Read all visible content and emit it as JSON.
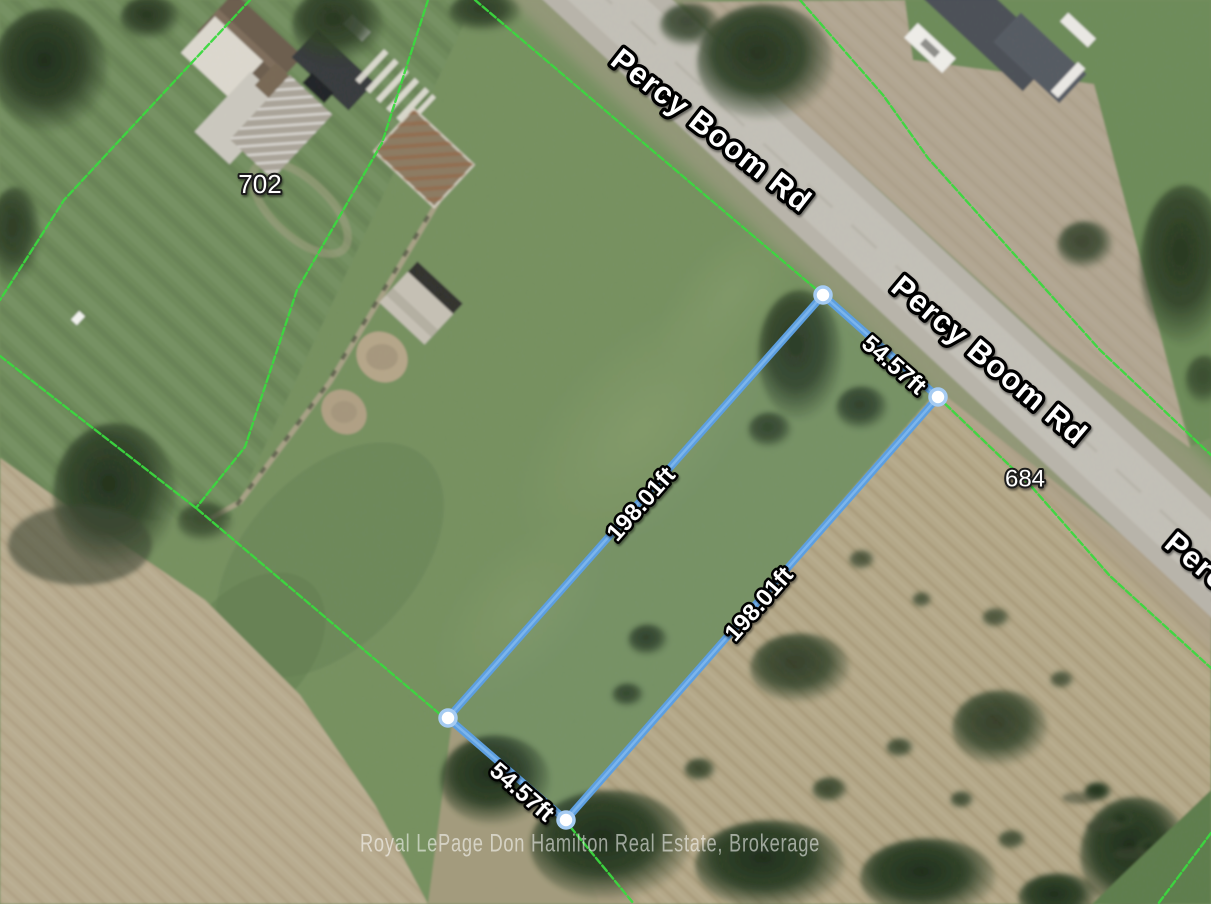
{
  "map": {
    "roads": {
      "label_1": "Percy Boom Rd",
      "label_2": "Percy Boom Rd",
      "label_3": "Percy Boom Rd"
    },
    "addresses": {
      "house_702": "702",
      "house_684": "684"
    },
    "lot_measurements": {
      "frontage": "54.57ft",
      "rear": "54.57ft",
      "side_west": "198.01ft",
      "side_east": "198.01ft"
    },
    "watermark": "Royal LePage Don Hamilton Real Estate, Brokerage",
    "colors": {
      "lot_outline": "#5d9fe0",
      "lot_outline_inner": "#8ec2f2",
      "vertex_fill": "#ffffff",
      "vertex_ring": "#a5cbf2",
      "parcel_line": "#3bd83f",
      "grass": "#75905f",
      "dry_field": "#b5a888",
      "road_surface": "#b9b5ab"
    }
  }
}
